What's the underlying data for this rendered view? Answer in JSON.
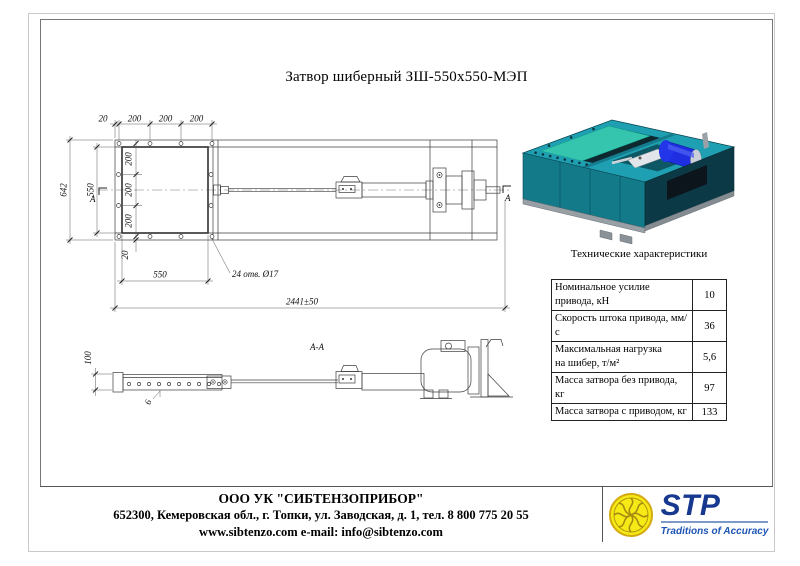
{
  "title": "Затвор шиберный ЗШ-550х550-МЭП",
  "drawing": {
    "top_view": {
      "dims_top": [
        "20",
        "200",
        "200",
        "200"
      ],
      "dim_total_height": "642",
      "dim_opening_height": "550",
      "dims_left": [
        "200",
        "200",
        "200"
      ],
      "dim_offset_bottom": "20",
      "dim_opening_width": "550",
      "holes_note": "24 отв. Ø17",
      "dim_total_length": "2441±50",
      "section_letter": "А"
    },
    "side_view": {
      "section_label": "А-А",
      "dim_height": "100",
      "dim_thickness": "6"
    }
  },
  "specs": {
    "heading": "Технические характеристики",
    "rows": [
      {
        "label": "Номинальное усилие привода, кН",
        "value": "10"
      },
      {
        "label": "Скорость штока привода, мм/с",
        "value": "36"
      },
      {
        "label": "Максимальная нагрузка",
        "label2": "на шибер, т/м²",
        "value": "5,6"
      },
      {
        "label": "Масса затвора без привода, кг",
        "value": "97"
      },
      {
        "label": "Масса затвора с приводом, кг",
        "value": "133"
      }
    ]
  },
  "footer": {
    "company": "ООО УК \"СИБТЕНЗОПРИБОР\"",
    "address": "652300, Кемеровская обл., г. Топки, ул. Заводская, д. 1, тел. 8 800 775 20 55",
    "web": "www.sibtenzo.com e-mail: info@sibtenzo.com",
    "logo": {
      "text": "STP",
      "tagline": "Traditions of Accuracy"
    }
  },
  "colors": {
    "body_teal": "#1fa0b2",
    "gate_green": "#35c4ae",
    "motor_blue": "#1e2ee0",
    "logo_blue": "#16388f",
    "logo_yellow": "#f6ea16"
  }
}
